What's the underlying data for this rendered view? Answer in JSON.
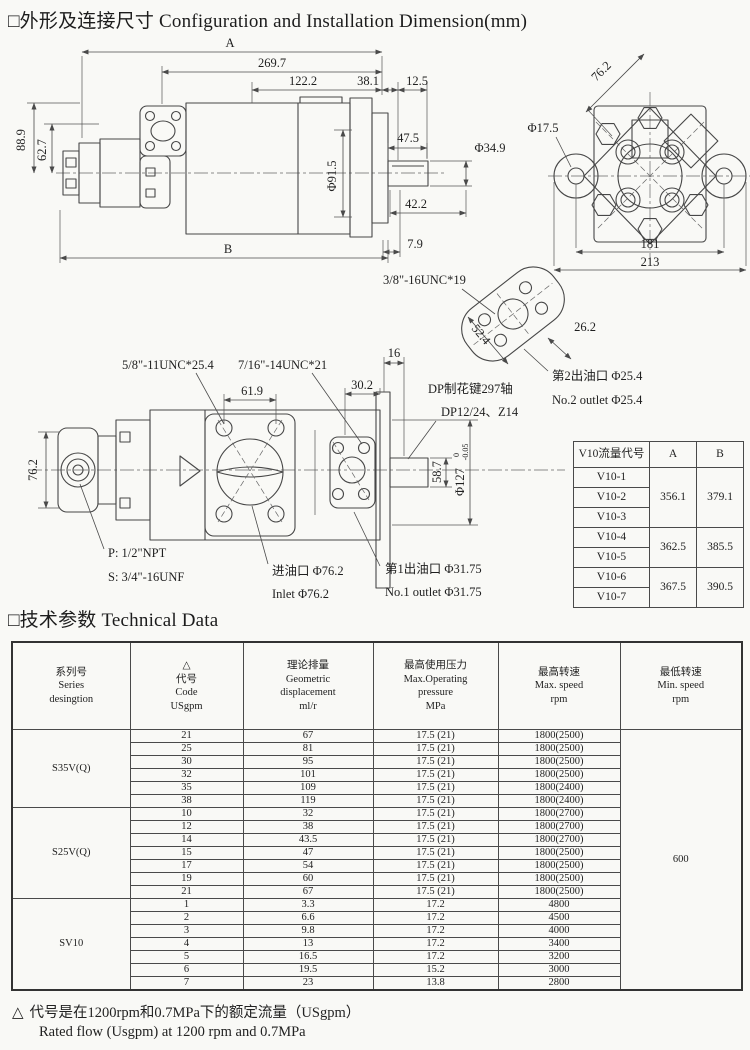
{
  "page": {
    "title": {
      "cn": "□外形及连接尺寸",
      "en": "Configuration and Installation Dimension(mm)"
    },
    "section_tech": {
      "cn": "□技术参数",
      "en": "Technical Data"
    },
    "footnote": {
      "mark": "△",
      "cn": "代号是在1200rpm和0.7MPa下的额定流量（USgpm）",
      "en": "Rated flow (Usgpm) at 1200 rpm and 0.7MPa"
    }
  },
  "side_view": {
    "A": "A",
    "B": "B",
    "len_269_7": "269.7",
    "len_122_2": "122.2",
    "len_38_1": "38.1",
    "len_12_5": "12.5",
    "h_88_9": "88.9",
    "h_62_7": "62.7",
    "dia_91_5": "Φ91.5",
    "len_47_5": "47.5",
    "dia_34_9": "Φ34.9",
    "len_42_2": "42.2",
    "len_7_9": "7.9"
  },
  "end_view": {
    "d_76_2": "76.2",
    "dia_17_5": "Φ17.5",
    "w_181": "181",
    "w_213": "213"
  },
  "outlet_flange": {
    "thread": "3/8\"-16UNC*19",
    "d_52_4": "52.4",
    "d_26_2": "26.2",
    "outlet2_cn": "第2出油口 Φ25.4",
    "outlet2_en": "No.2 outlet Φ25.4"
  },
  "mid_view": {
    "thread_a": "5/8\"-11UNC*25.4",
    "thread_b": "7/16\"-14UNC*21",
    "len_61_9": "61.9",
    "len_30_2": "30.2",
    "len_16": "16",
    "h_76_2": "76.2",
    "port_p": "P: 1/2\"NPT",
    "port_s": "S: 3/4\"-16UNF",
    "inlet_cn": "进油口  Φ76.2",
    "inlet_en": "Inlet  Φ76.2",
    "spline_cn": "DP制花键297轴",
    "spline_en": "DP12/24、Z14",
    "h_58_7": "58.7",
    "dia_127": "Φ127",
    "tol_hi": "0",
    "tol_lo": "-0.05",
    "outlet1_cn": "第1出油口  Φ31.75",
    "outlet1_en": "No.1 outlet  Φ31.75"
  },
  "flow_table": {
    "col_code": "V10流量代号",
    "col_a": "A",
    "col_b": "B",
    "groups": [
      {
        "codes": [
          "V10-1",
          "V10-2",
          "V10-3"
        ],
        "a": "356.1",
        "b": "379.1"
      },
      {
        "codes": [
          "V10-4",
          "V10-5"
        ],
        "a": "362.5",
        "b": "385.5"
      },
      {
        "codes": [
          "V10-6",
          "V10-7"
        ],
        "a": "367.5",
        "b": "390.5"
      }
    ]
  },
  "tech_table": {
    "headers": [
      "系列号\nSeries\ndesingtion",
      "△\n代号\nCode\nUSgpm",
      "理论排量\nGeometric\ndisplacement\nml/r",
      "最高使用压力\nMax.Operating\npressure\nMPa",
      "最高转速\nMax. speed\nrpm",
      "最低转速\nMin. speed\nrpm"
    ],
    "min_speed": "600",
    "groups": [
      {
        "series": "S35V(Q)",
        "rows": [
          [
            "21",
            "67",
            "17.5 (21)",
            "1800(2500)"
          ],
          [
            "25",
            "81",
            "17.5 (21)",
            "1800(2500)"
          ],
          [
            "30",
            "95",
            "17.5 (21)",
            "1800(2500)"
          ],
          [
            "32",
            "101",
            "17.5 (21)",
            "1800(2500)"
          ],
          [
            "35",
            "109",
            "17.5 (21)",
            "1800(2400)"
          ],
          [
            "38",
            "119",
            "17.5 (21)",
            "1800(2400)"
          ]
        ]
      },
      {
        "series": "S25V(Q)",
        "rows": [
          [
            "10",
            "32",
            "17.5 (21)",
            "1800(2700)"
          ],
          [
            "12",
            "38",
            "17.5 (21)",
            "1800(2700)"
          ],
          [
            "14",
            "43.5",
            "17.5 (21)",
            "1800(2700)"
          ],
          [
            "15",
            "47",
            "17.5 (21)",
            "1800(2500)"
          ],
          [
            "17",
            "54",
            "17.5 (21)",
            "1800(2500)"
          ],
          [
            "19",
            "60",
            "17.5 (21)",
            "1800(2500)"
          ],
          [
            "21",
            "67",
            "17.5 (21)",
            "1800(2500)"
          ]
        ]
      },
      {
        "series": "SV10",
        "rows": [
          [
            "1",
            "3.3",
            "17.2",
            "4800"
          ],
          [
            "2",
            "6.6",
            "17.2",
            "4500"
          ],
          [
            "3",
            "9.8",
            "17.2",
            "4000"
          ],
          [
            "4",
            "13",
            "17.2",
            "3400"
          ],
          [
            "5",
            "16.5",
            "17.2",
            "3200"
          ],
          [
            "6",
            "19.5",
            "15.2",
            "3000"
          ],
          [
            "7",
            "23",
            "13.8",
            "2800"
          ]
        ]
      }
    ]
  },
  "colors": {
    "line": "#474747",
    "text": "#1f1f1f",
    "paper": "#f9f9f6"
  }
}
